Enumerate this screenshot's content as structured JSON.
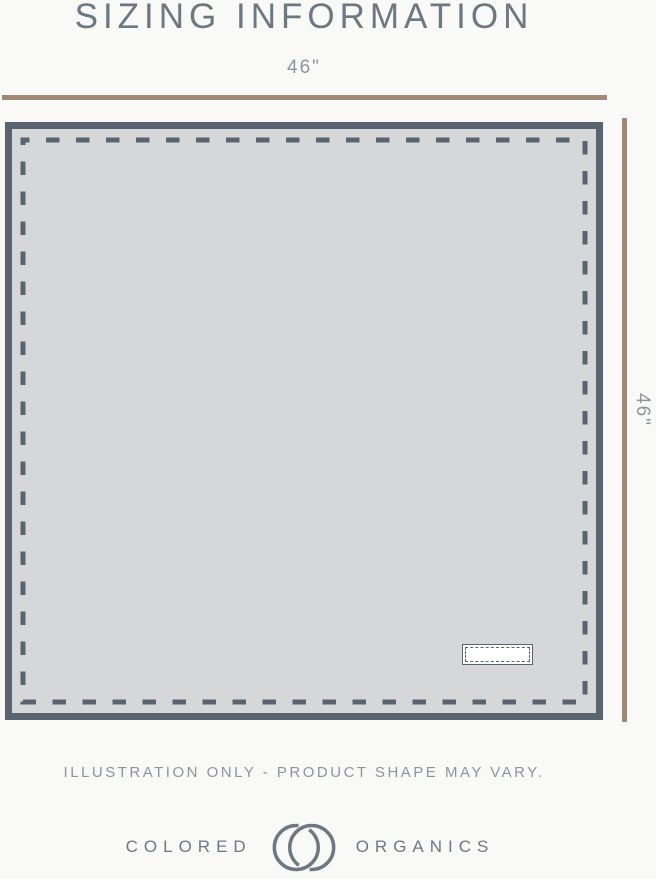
{
  "header": {
    "title": "SIZING INFORMATION"
  },
  "diagram": {
    "illustration": "square-blanket-with-stitched-border-and-tag",
    "width_label": "46\"",
    "height_label": "46\""
  },
  "footer": {
    "disclaimer": "ILLUSTRATION ONLY - PRODUCT SHAPE MAY VARY."
  },
  "brand": {
    "name_left": "COLORED",
    "name_right": "ORGANICS",
    "logo": "interlocking-c-rings"
  },
  "colors": {
    "background": "#f9f9f8",
    "heading_text": "#6e7881",
    "label_text": "#8d959b",
    "measure_line": "#a18977",
    "fabric_border": "#5a646e",
    "fabric_fill": "#d5d7d9",
    "tag_fill": "#ffffff"
  }
}
